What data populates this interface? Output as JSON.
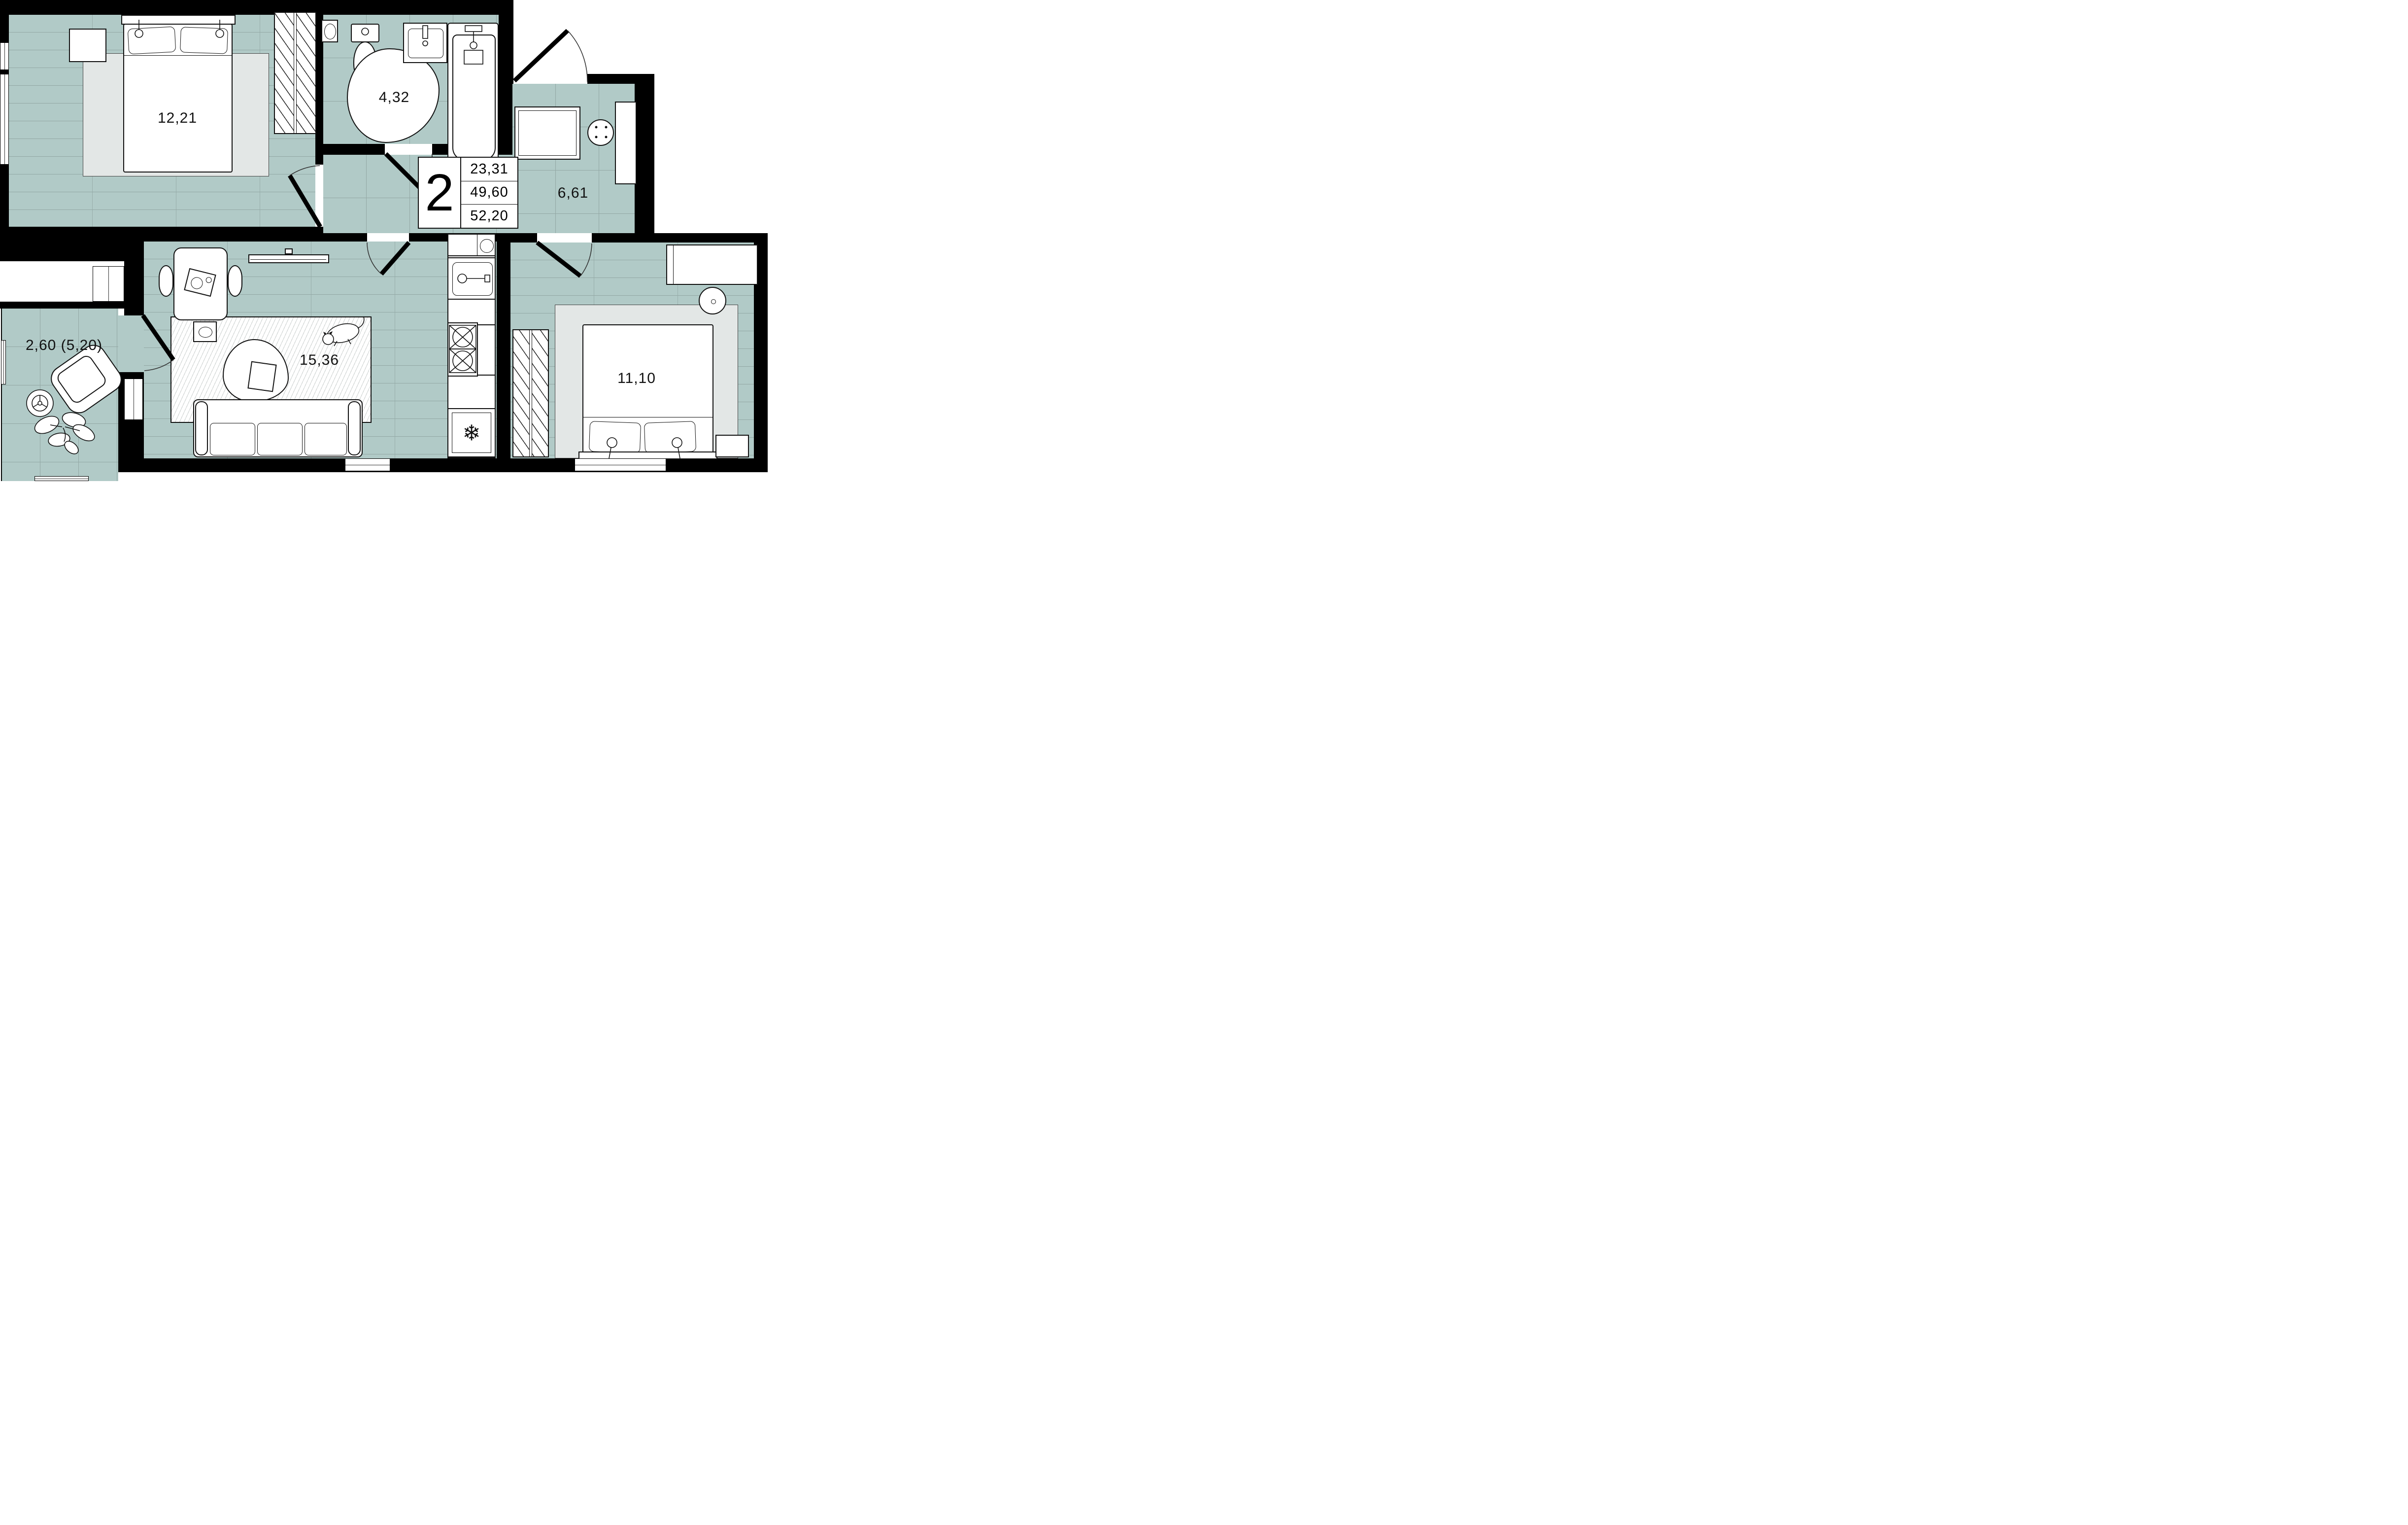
{
  "title": "2-room apartment floor plan",
  "info_box": {
    "rooms_count": "2",
    "living_area": "23,31",
    "apartment_area": "49,60",
    "total_area": "52,20"
  },
  "rooms": {
    "bedroom1": {
      "name": "bedroom-1",
      "area": "12,21"
    },
    "bathroom": {
      "name": "bathroom",
      "area": "4,32"
    },
    "hallway": {
      "name": "hallway",
      "area": "6,61"
    },
    "living_room": {
      "name": "living-room",
      "area": "15,36"
    },
    "bedroom2": {
      "name": "bedroom-2",
      "area": "11,10"
    },
    "balcony": {
      "name": "balcony",
      "area": "2,60 (5,20)"
    }
  },
  "icons": {
    "fridge_snowflake": "❄"
  },
  "colors": {
    "floor": "#b1cac7",
    "wall": "#000000",
    "grout": "#93a8a5",
    "rug_gray": "#e3e7e6"
  }
}
